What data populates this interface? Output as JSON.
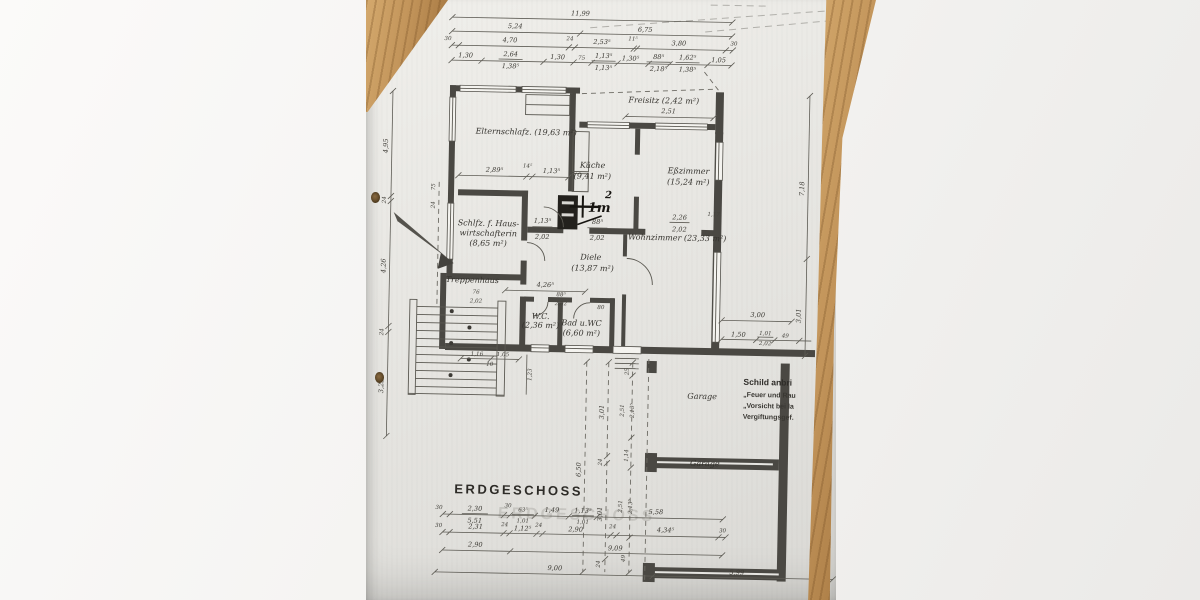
{
  "title": {
    "text": "ERDGESCHOSS"
  },
  "watermark": {
    "text": "ERDGESCHOSS"
  },
  "pen_note": {
    "base": "1m",
    "sup": "2"
  },
  "stamp": {
    "l1": "Schild anbri",
    "l2": "„Feuer und Rau",
    "l3": "„Vorsicht bei la",
    "l4": "Vergiftungsgef."
  },
  "rooms": {
    "eltern": "Elternschlafz. (19,63 m²)",
    "freisitz": "Freisitz (2,42 m²)",
    "kueche1": "Küche",
    "kueche2": "(9,41 m²)",
    "esszimmer1": "Eßzimmer",
    "esszimmer2": "(15,24 m²)",
    "schlfz1": "Schlfz. f. Haus-",
    "schlfz2": "wirtschafterin",
    "schlfz3": "(8,65 m²)",
    "diele1": "Diele",
    "diele2": "(13,87 m²)",
    "wohnzimmer": "Wohnzimmer (23,33 m²)",
    "treppenhaus": "Treppenhaus",
    "wc1": "W.C.",
    "wc2": "(2,36 m²)",
    "bad1": "Bad u.WC",
    "bad2": "(6,60 m²)",
    "garage1": "Garage",
    "garage2": "Garage"
  },
  "dims": {
    "t0": [
      "11,99"
    ],
    "t1": [
      "5,24",
      "6,75"
    ],
    "t2": [
      "30",
      "4,70",
      "24",
      "2,53⁵",
      "11⁵",
      "3,80",
      "30"
    ],
    "t3": [
      "1,30",
      "2,64",
      "1,38⁵",
      "1,30",
      "75",
      "1,13⁵",
      "1,13⁵",
      "1,30⁵",
      "88⁵",
      "2,18⁵",
      "1,62⁵",
      "1,38⁵",
      "1,05"
    ],
    "left": [
      "4,95",
      "24",
      "4,26",
      "24",
      "3,25"
    ],
    "left_small": [
      "75",
      "24"
    ],
    "right": [
      "7,18",
      "3,01"
    ],
    "freisitz": [
      "2,51"
    ],
    "eltern": [
      "2,89⁵",
      "14⁵",
      "1,13⁵"
    ],
    "inner": [
      "88⁵",
      "2,02",
      "1,13⁵",
      "2,02",
      "2,26",
      "2,02",
      "1,17",
      "4,26⁵",
      "76",
      "2,02",
      "88⁵",
      "2,02",
      "80",
      "1,23",
      "1,16",
      "1,05",
      "10"
    ],
    "right_side": [
      "3,00",
      "1,50",
      "1,01",
      "2,02",
      "49"
    ],
    "v1": [
      "6,50"
    ],
    "v2": [
      "3,01",
      "24",
      "3,01",
      "24"
    ],
    "v3": [
      "25",
      "2,51",
      "2,13⁵",
      "1,14",
      "2,51",
      "2,13⁵",
      "49"
    ],
    "bA": [
      "30",
      "2,30",
      "5,51",
      "30",
      "63⁵",
      "1,01",
      "1,49",
      "1,13⁵",
      "1,01",
      "5,58"
    ],
    "bB": [
      "30",
      "2,31",
      "24",
      "1,12⁵",
      "24",
      "2,90",
      "24",
      "4,34⁵",
      "30"
    ],
    "bC": [
      "2,90",
      "9,09"
    ],
    "bD": [
      "9,00",
      "5,99"
    ]
  }
}
